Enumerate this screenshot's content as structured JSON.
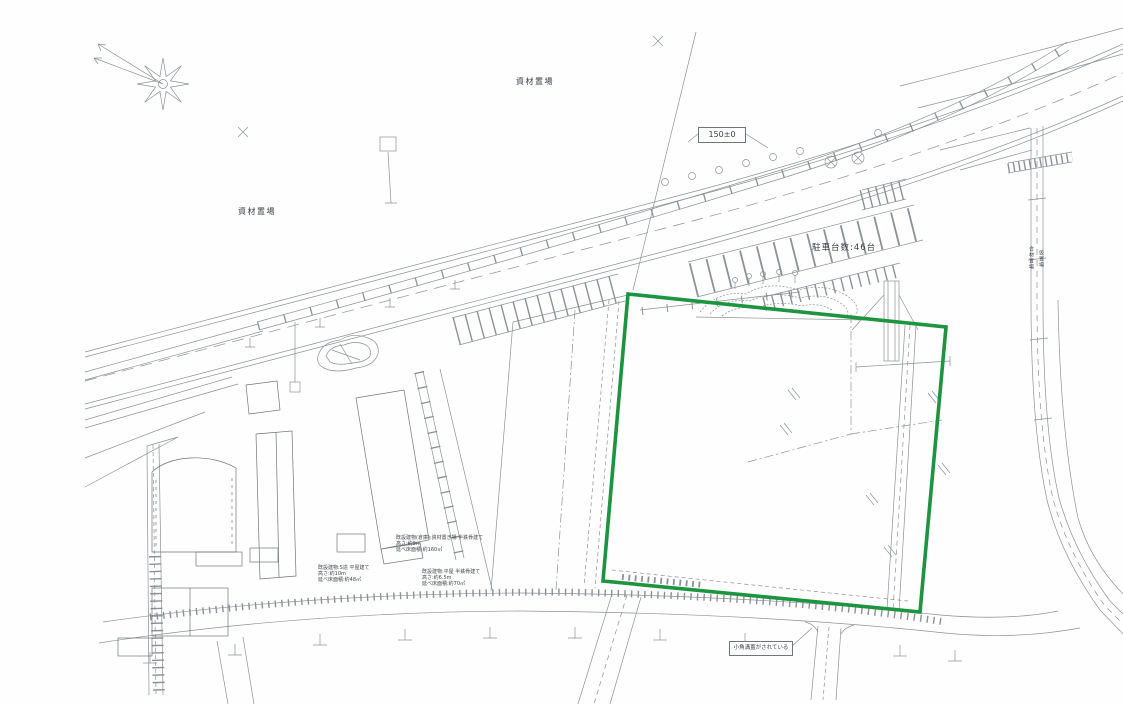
{
  "page": {
    "background": "#ffffff"
  },
  "drawing": {
    "type": "scanned-site-plan",
    "colors": {
      "linework": "#8d9196",
      "linework_dark": "#70757b",
      "site_boundary_green": "#1d9440",
      "text": "#3a3f46"
    },
    "labels": {
      "material_yard_top": "資材置場",
      "material_yard_left": "資材置場",
      "level_mark": "150±0",
      "parking_count": "駐車台数:46台",
      "gutter_note": "小角溝蓋がされている",
      "vertical_note_1": "合材置場",
      "vertical_note_2": "仮置場"
    },
    "building_notes": {
      "a": [
        "既設建物(倉庫):資材置き場 半鉄骨建て",
        "高さ:約9m",
        "延べ床面積:約160㎡"
      ],
      "b": [
        "既設建物:S造 平屋建て",
        "高さ:約10m",
        "延べ床面積:約48㎡"
      ],
      "c": [
        "既設建物:平屋 半鉄骨建て",
        "高さ:約6.5m",
        "延べ床面積:約70㎡"
      ]
    },
    "site_boundary": {
      "shape": "quadrilateral",
      "points_px": [
        [
          628,
          294
        ],
        [
          946,
          327
        ],
        [
          920,
          612
        ],
        [
          603,
          581
        ]
      ],
      "color": "#1d9440"
    }
  }
}
